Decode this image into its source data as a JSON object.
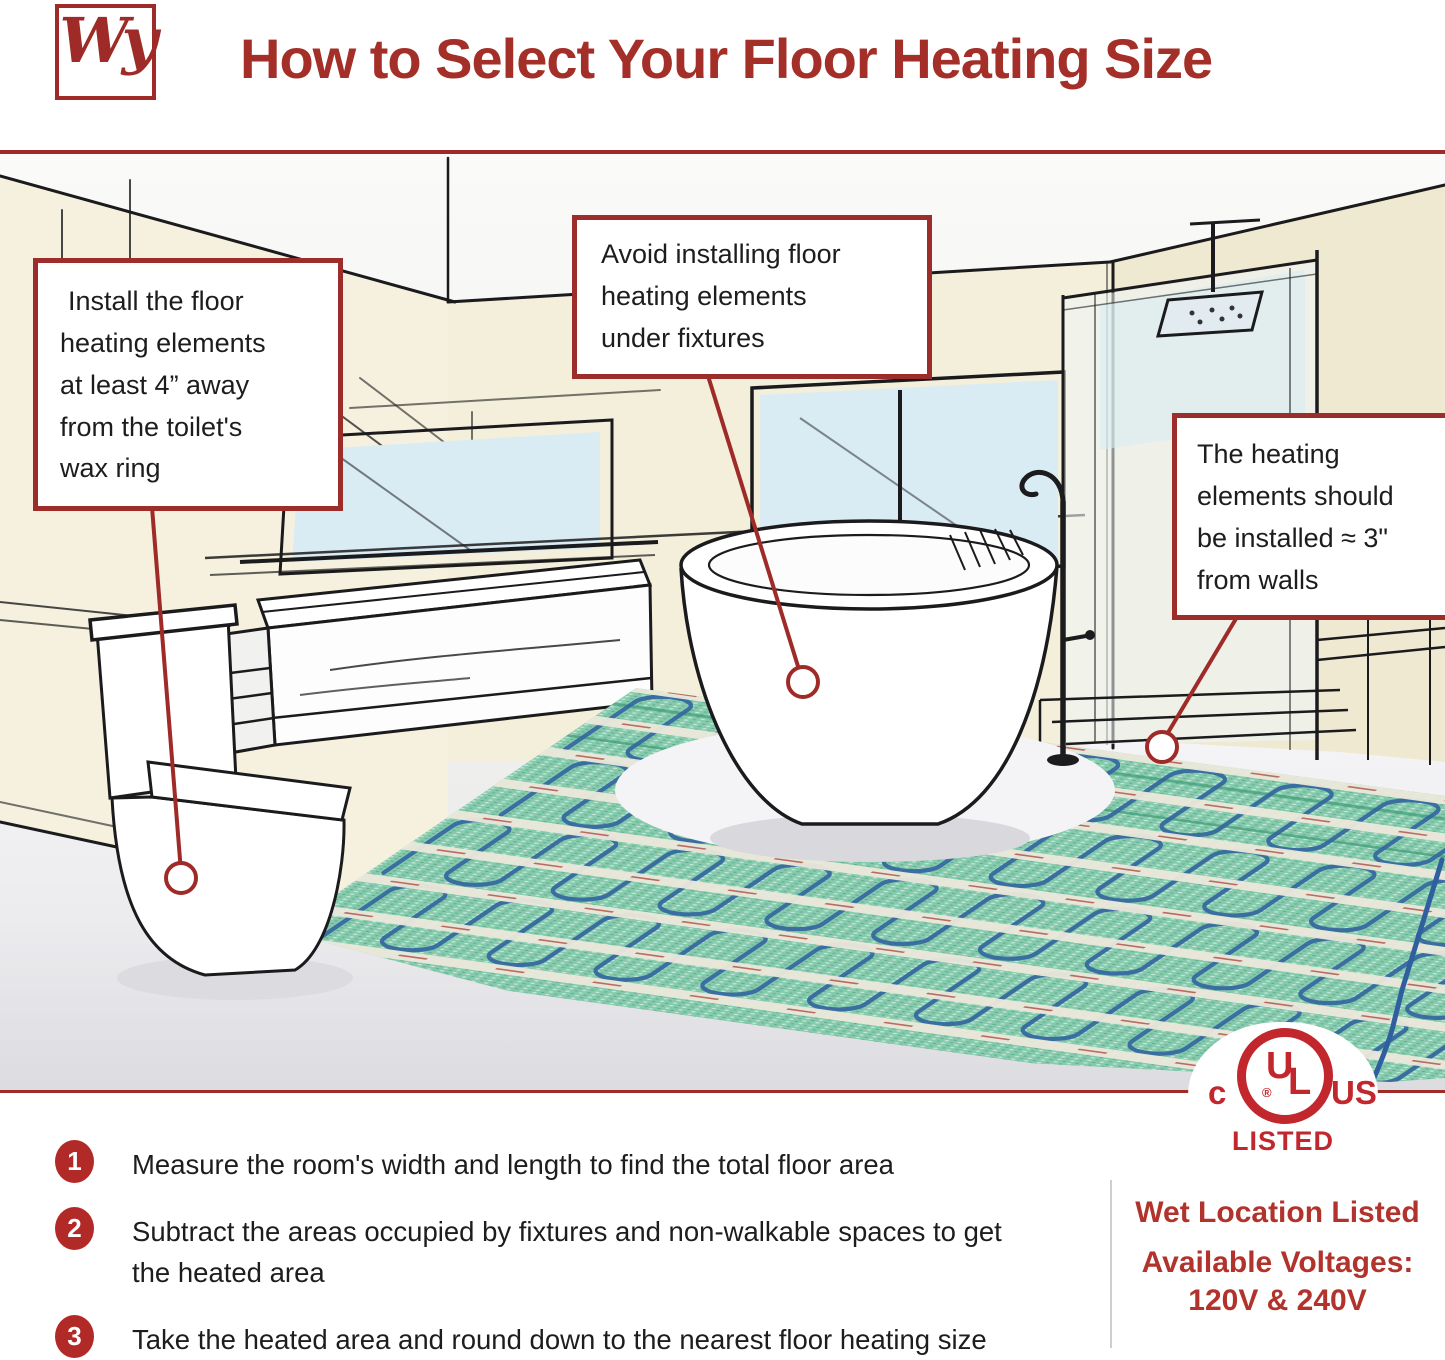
{
  "header": {
    "logo_text": "Wy",
    "title": "How to Select Your Floor Heating Size"
  },
  "callouts": {
    "toilet": {
      "lines": [
        "Install the floor",
        "heating elements",
        "at least 4” away",
        "from the toilet's",
        "wax ring"
      ]
    },
    "fixtures": {
      "lines": [
        "Avoid installing floor",
        "heating elements",
        "under fixtures"
      ]
    },
    "walls": {
      "lines": [
        "The heating",
        "elements should",
        "be installed ≈ 3\"",
        "from walls"
      ]
    }
  },
  "steps": [
    {
      "number": "1",
      "text": "Measure the room's width and length to find the total floor area"
    },
    {
      "number": "2",
      "text": "Subtract the areas occupied by fixtures and non-walkable spaces to get the heated area"
    },
    {
      "number": "3",
      "text": "Take the heated area and round down to the nearest floor heating size"
    }
  ],
  "certification": {
    "c": "c",
    "ul_u": "U",
    "ul_l": "L",
    "us": "US",
    "registered": "®",
    "listed": "LISTED",
    "wet_location": "Wet Location Listed",
    "voltages_label": "Available Voltages:",
    "voltages_value": "120V & 240V"
  },
  "colors": {
    "accent_red": "#9e2b27",
    "ul_red": "#c1272d",
    "mat_green": "#85caac",
    "wire_blue": "#34679f",
    "wall_cream": "#f3efdb",
    "window_blue": "#d9ecf4"
  }
}
